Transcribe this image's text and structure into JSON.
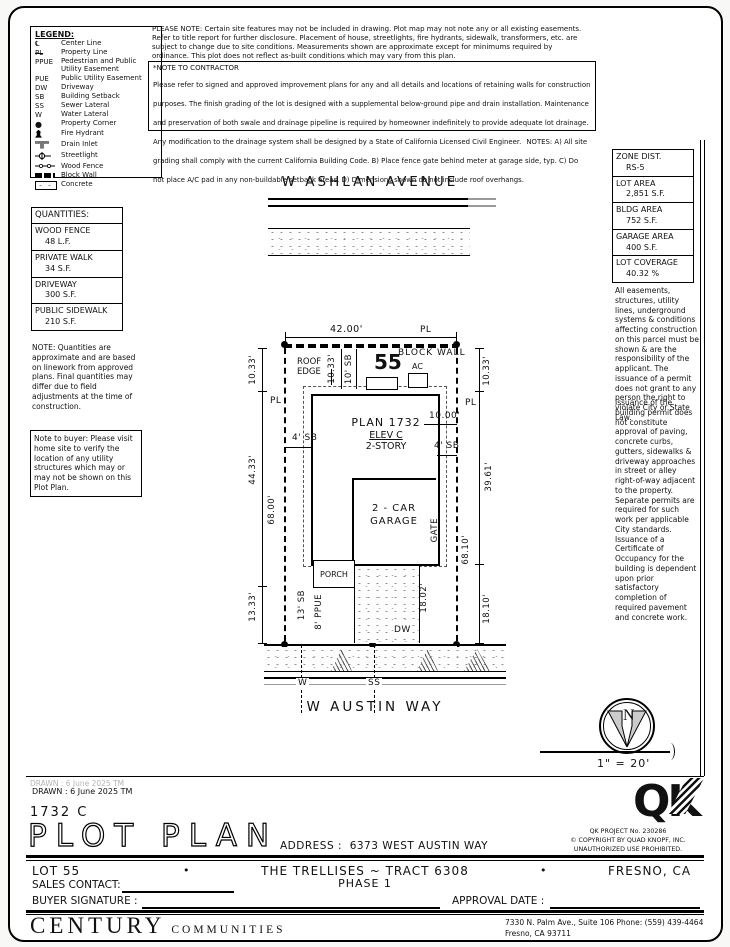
{
  "legend": {
    "title": "LEGEND:",
    "items": [
      {
        "symbol": "℄",
        "label": "Center Line"
      },
      {
        "symbol": "PL",
        "label": "Property Line"
      },
      {
        "symbol": "PPUE",
        "label": "Pedestrian and Public Utility Easement"
      },
      {
        "symbol": "PUE",
        "label": "Public Utility Easement"
      },
      {
        "symbol": "DW",
        "label": "Driveway"
      },
      {
        "symbol": "SB",
        "label": "Building Setback"
      },
      {
        "symbol": "SS",
        "label": "Sewer Lateral"
      },
      {
        "symbol": "W",
        "label": "Water Lateral"
      },
      {
        "symbol": "●",
        "label": "Property Corner"
      },
      {
        "symbol": "",
        "label": "Fire Hydrant"
      },
      {
        "symbol": "",
        "label": "Drain Inlet"
      },
      {
        "symbol": "",
        "label": "Streetlight"
      },
      {
        "symbol": "",
        "label": "Wood Fence"
      },
      {
        "symbol": "",
        "label": "Block Wall"
      },
      {
        "symbol": "",
        "label": "Concrete"
      }
    ]
  },
  "top_note": "PLEASE NOTE:  Certain site features may not be included in drawing.  Plot map may not note any or all existing easements. Refer to title report for further disclosure.  Placement of house, streetlights, fire hydrants, sidewalk, transformers, etc. are subject to change due to site conditions.  Measurements shown are approximate except for minimums required by ordinance.  This plot does not reflect as-built conditions which may vary from this plan.",
  "contractor": {
    "title": "*NOTE TO CONTRACTOR",
    "body": "Please refer to signed and approved improvement plans for any and all details and locations of retaining walls for construction purposes. The finish grading of the lot is designed with a supplemental below-ground pipe and drain installation.  Maintenance and preservation of both swale and drainage pipeline is required by homeowner indefinitely to provide adequate lot drainage.  Any modification to the drainage system shall be designed by a State of California Licensed Civil Engineer.",
    "notes": "NOTES:  A) All site grading shall comply with the current California Building Code.  B) Place fence gate behind meter at garage side, typ.  C) Do not place A/C pad in any non-buildable setback areas.  D) Dimensions shown do not include roof overhangs."
  },
  "zoning": {
    "rows": [
      {
        "label": "ZONE DIST.",
        "value": "RS-5"
      },
      {
        "label": "LOT AREA",
        "value": "2,851 S.F."
      },
      {
        "label": "BLDG AREA",
        "value": "752 S.F."
      },
      {
        "label": "GARAGE AREA",
        "value": "400 S.F."
      },
      {
        "label": "LOT COVERAGE",
        "value": "40.32 %"
      }
    ]
  },
  "easement_note1": "All easements, structures, utility lines, underground systems & conditions affecting construction on this parcel must be shown & are the responsibility of the applicant. The issuance of a permit does not grant to any person the right to violate City or State Law.",
  "easement_note2": "Issuance of the building permit does not constitute approval of paving, concrete curbs, gutters, sidewalks & driveway approaches in street or alley right-of-way adjacent to the property. Separate permits are required for such work per applicable City standards. Issuance of a Certificate of Occupancy for the building is dependent upon prior satisfactory completion of required pavement and concrete work.",
  "quantities": {
    "title": "QUANTITIES:",
    "rows": [
      {
        "label": "WOOD FENCE",
        "value": "48 L.F."
      },
      {
        "label": "PRIVATE WALK",
        "value": "34 S.F."
      },
      {
        "label": "DRIVEWAY",
        "value": "300 S.F."
      },
      {
        "label": "PUBLIC SIDEWALK",
        "value": "210 S.F."
      }
    ]
  },
  "quantities_note": "NOTE: Quantities are approximate and are based on linework from approved plans.  Final quantities may differ due to field adjustments at the time of construction.",
  "buyer_note": "Note to buyer: Please visit home site to verify the location of any utility structures which may or may not be shown on this Plot Plan.",
  "plot": {
    "street_top": "W ASHLAN AVENUE",
    "street_bottom": "W AUSTIN WAY",
    "lot_number": "55",
    "block_wall_label": "BLOCK WALL",
    "roof_edge_label": "ROOF\nEDGE",
    "ac_label": "AC",
    "plan_name": "PLAN 1732",
    "plan_elev": "ELEV C",
    "plan_story": "2-STORY",
    "garage_line1": "2 - CAR",
    "garage_line2": "GARAGE",
    "porch_label": "PORCH",
    "gate_label": "GATE",
    "dw_label": "DW",
    "dims": {
      "pl": "PL",
      "top_width": "42.00'",
      "left_top": "10.33'",
      "left_mid": "44.33'",
      "left_bottom": "13.33'",
      "left_depth": "68.00'",
      "right_top": "10.33'",
      "right_mid": "39.61'",
      "right_bottom": "18.10'",
      "right_depth": "68.10'",
      "front_sb": "10' SB",
      "front_sb_dim": "10.33'",
      "side_sb_left": "4' SB",
      "side_sb_right": "4' SB",
      "garage_offset": "10.00'",
      "drive_depth": "18.02'",
      "street_sb": "13' SB",
      "ppue": "8' PPUE",
      "frontage_left": "21.92'",
      "frontage_right": "20.08'"
    },
    "laterals": {
      "water": "W",
      "sewer": "SS"
    }
  },
  "north_label": "N",
  "scale_label": "1\" = 20'",
  "titleblock": {
    "drawn": "DRAWN :  6 June 2025  TM",
    "plan_code": "1732  C",
    "title": "PLOT PLAN",
    "address_label": "ADDRESS :",
    "address": "6373 WEST AUSTIN WAY",
    "qk_text": "QK",
    "qk_project": "QK PROJECT No. 230286",
    "qk_copyright": "©   COPYRIGHT BY QUAD KNOPF, INC.",
    "qk_prohibited": "UNAUTHORIZED USE PROHIBITED."
  },
  "footer": {
    "lot": "LOT 55",
    "bullet": "•",
    "tract": "THE TRELLISES ~ TRACT 6308",
    "phase": "PHASE 1",
    "city": "FRESNO, CA",
    "sales_contact": "SALES CONTACT:",
    "buyer_signature": "BUYER SIGNATURE :",
    "approval_date": "APPROVAL DATE :",
    "company": "CENTURY",
    "communities": "COMMUNITIES",
    "addr_line1": "7330 N. Palm Ave., Suite 106   Phone:  (559) 439-4464",
    "addr_line2": "Fresno, CA  93711"
  }
}
